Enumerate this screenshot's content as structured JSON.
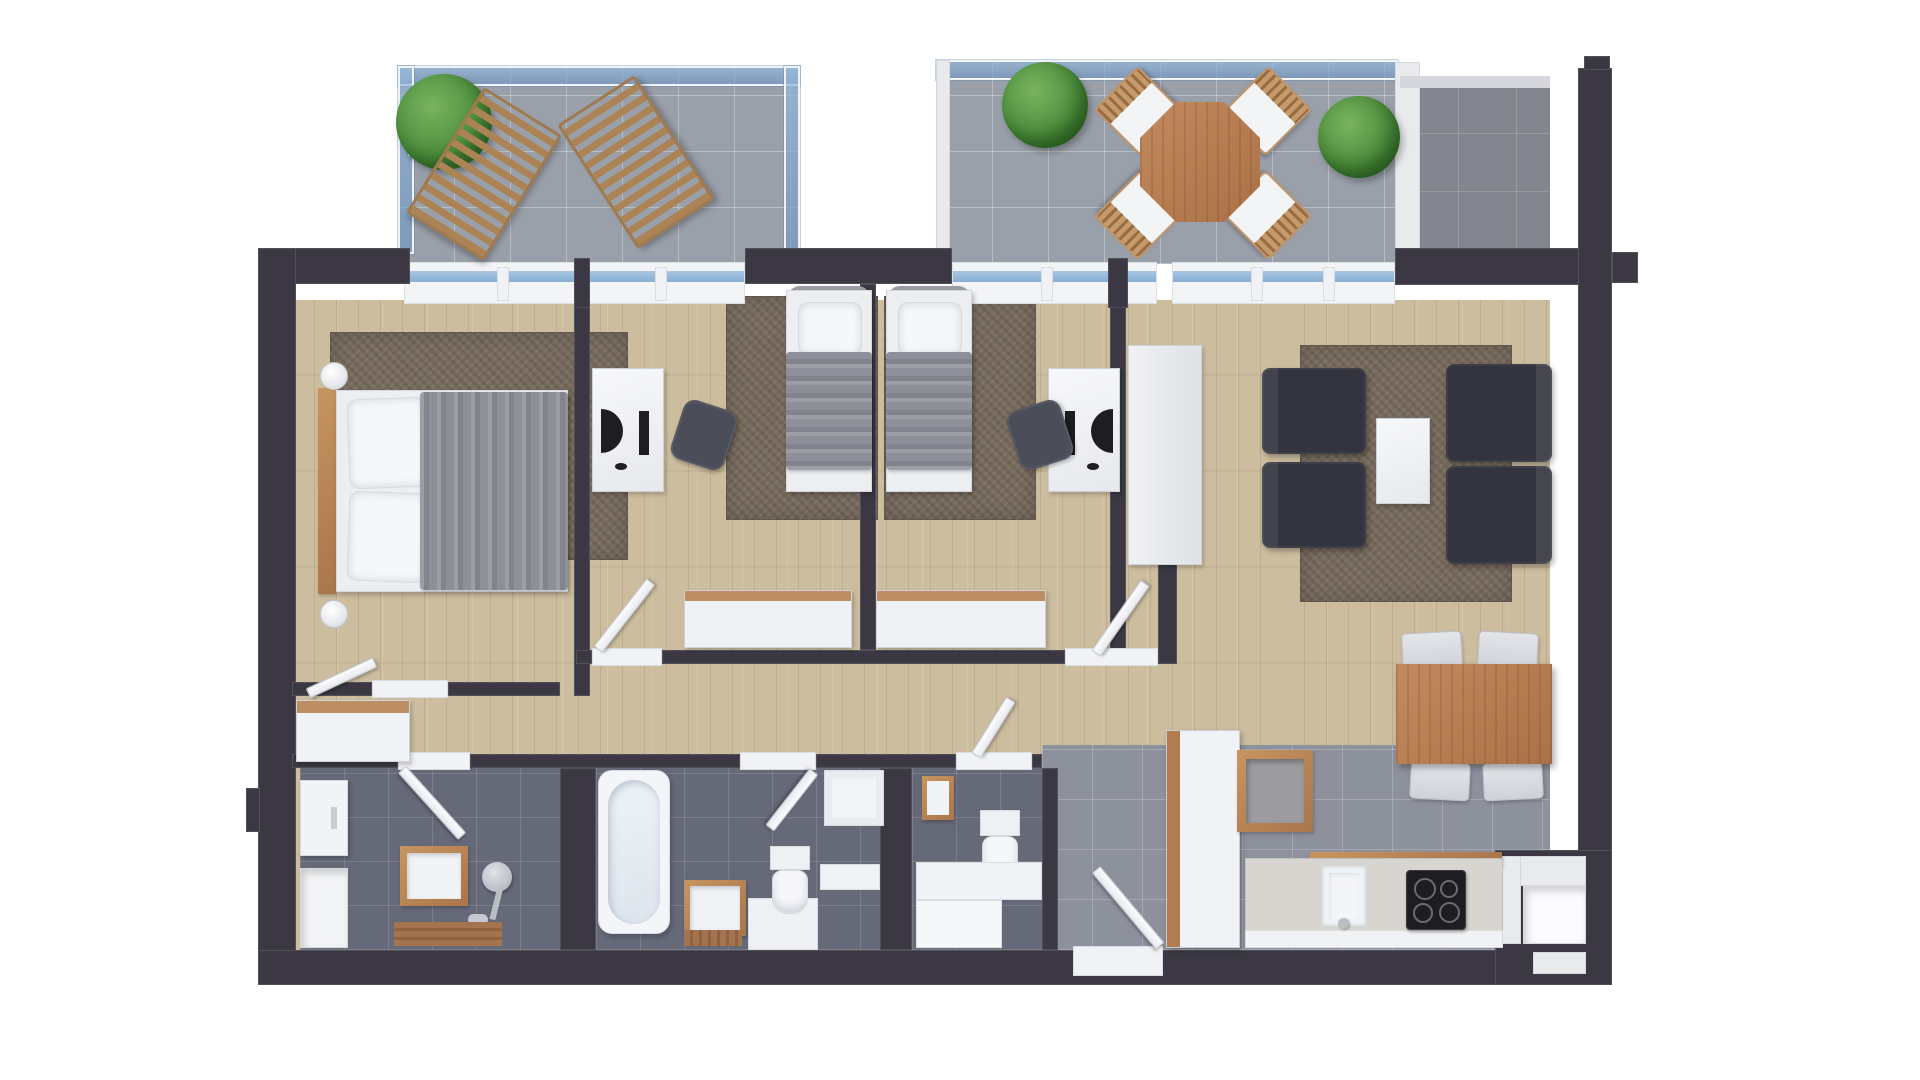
{
  "scene": {
    "title": "Top-down 3D rendered apartment floor plan",
    "type": "floor-plan",
    "view": "top-down 3D render",
    "text_visible": "none"
  },
  "palette": {
    "background": "#ffffff",
    "wall": "#3b3843",
    "wood_floor": "#cdbd9f",
    "balcony_tile": "#9aa0aa",
    "terrace_tile": "#83868f",
    "bathroom_tile": "#656978",
    "kitchen_tile": "#8d919c",
    "rug": "#786b5f",
    "glass_railing": "#7da8d0",
    "white_furniture": "#f2f3f6",
    "wood_furniture": "#b9875d",
    "sofa": "#33343e",
    "blanket": "#8e9099",
    "plant": "#4e8f3d",
    "cooktop": "#1d1d22"
  },
  "rooms": [
    {
      "id": "balcony-left",
      "label": "Balcony with sun loungers"
    },
    {
      "id": "balcony-main",
      "label": "Balcony with dining set"
    },
    {
      "id": "terrace-corner",
      "label": "Corner terrace"
    },
    {
      "id": "master-bedroom",
      "label": "Master bedroom"
    },
    {
      "id": "bedroom-2",
      "label": "Bedroom 2"
    },
    {
      "id": "bedroom-3",
      "label": "Bedroom 3"
    },
    {
      "id": "living-room",
      "label": "Living room"
    },
    {
      "id": "dining-area",
      "label": "Dining area"
    },
    {
      "id": "kitchen",
      "label": "Kitchen"
    },
    {
      "id": "hallway",
      "label": "Hallway"
    },
    {
      "id": "shower-room",
      "label": "Shower room"
    },
    {
      "id": "bathroom",
      "label": "Bathroom with tub"
    },
    {
      "id": "wc",
      "label": "WC"
    },
    {
      "id": "entrance",
      "label": "Entrance hall"
    }
  ],
  "furniture": [
    "two wooden sun loungers",
    "planter with shrub",
    "octagonal wooden table",
    "four wooden chairs with white cushions",
    "two potted shrubs",
    "double bed with gray throw",
    "two round bedside lamps",
    "sideboard with wood top",
    "two single beds with gray throws",
    "two white desks with desktop items",
    "two dark office chairs",
    "two white wardrobes with wood tops",
    "TV console",
    "two dark armchairs",
    "dark two-seat sofa sections",
    "white coffee table",
    "wooden dining table",
    "four gray dining chairs",
    "tall fridge cabinet",
    "wall-hung wooden cabinet",
    "kitchen counter with sink and 4-burner cooktop",
    "bathtub",
    "two wood vanities with sinks",
    "two toilets",
    "shower tray",
    "shower fixture",
    "wooden bath mats",
    "storage closet and niche"
  ]
}
